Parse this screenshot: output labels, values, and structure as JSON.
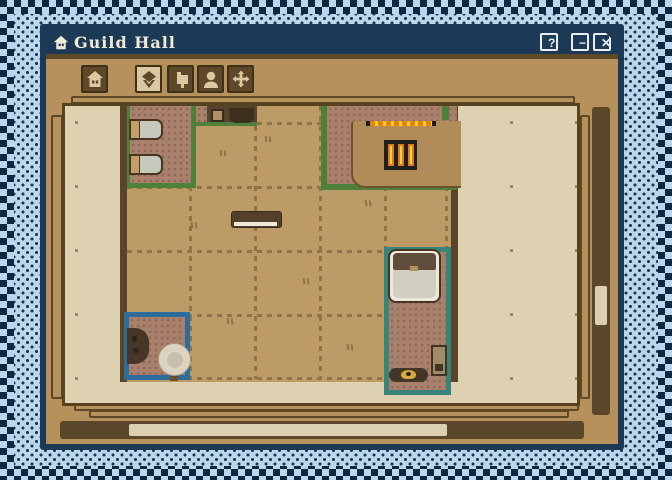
{
  "window": {
    "title": "Guild Hall",
    "title_icon": "house-icon",
    "controls": {
      "help": "?",
      "minimize": "−",
      "close": "✕"
    }
  },
  "toolbar": {
    "buttons": [
      {
        "name": "home",
        "icon": "home-icon",
        "selected": false
      },
      {
        "name": "objects",
        "icon": "cube-icon",
        "selected": true
      },
      {
        "name": "furniture",
        "icon": "furniture-icon",
        "selected": false
      },
      {
        "name": "people",
        "icon": "person-icon",
        "selected": false
      },
      {
        "name": "move",
        "icon": "move-arrows-icon",
        "selected": false
      }
    ]
  },
  "map": {
    "description": "top-down pixel-art floor plan of the guild hall",
    "rooms": [
      {
        "name": "room-top-left",
        "border_color": "#4e8039",
        "floor_color": "#a8806b",
        "furniture": [
          "bed",
          "bed",
          "dark-counter-with-crate"
        ]
      },
      {
        "name": "room-top-right",
        "border_color": "#4e8039",
        "floor_color": "#a8806b",
        "furniture": [
          "long-counter",
          "hot-coals-strip",
          "grill"
        ]
      },
      {
        "name": "room-right",
        "border_color": "#37857a",
        "floor_color": "#a8806b",
        "furniture": [
          "large-bed",
          "crate",
          "mat-with-bowl"
        ]
      },
      {
        "name": "room-bottom-left",
        "border_color": "#2d6d9b",
        "floor_color": "#a8806b",
        "furniture": [
          "cauldron",
          "round-table"
        ]
      }
    ],
    "hall_furniture": [
      "bench-table"
    ],
    "colors": {
      "titlebar": "#1c3a55",
      "frame": "#b6915c",
      "outside_floor": "#ddd1b2",
      "hall_floor": "#bc9b66",
      "wall": "#5a4529",
      "grid_dash": "#8d7449",
      "scroll_track": "#5b4729",
      "scroll_thumb": "#dcd0b2",
      "checker_light": "#b9d6ea",
      "checker_dark": "#0d2841"
    }
  },
  "scrollbars": {
    "horizontal": true,
    "vertical": true
  }
}
